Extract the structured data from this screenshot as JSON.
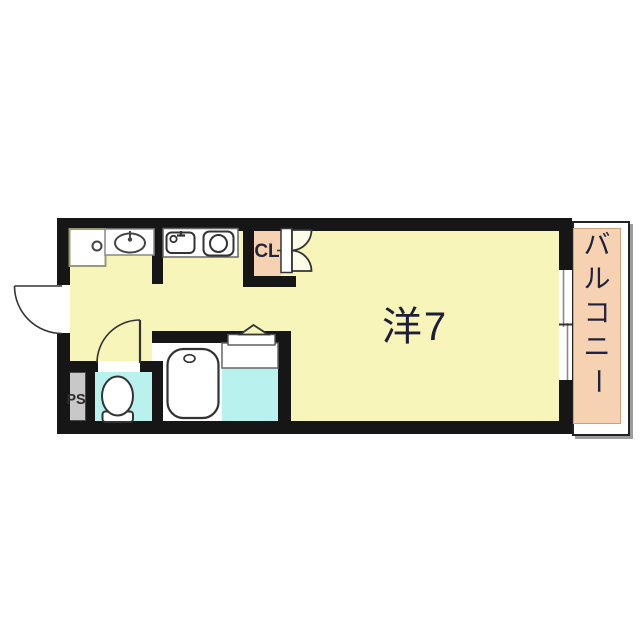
{
  "plan": {
    "labels": {
      "room": "洋7",
      "closet": "CL",
      "pipe_space": "PS",
      "balcony": "バルコニー"
    },
    "balcony_chars": [
      "バ",
      "ル",
      "コ",
      "ニ",
      "ー"
    ],
    "colors": {
      "floor_yellow": "#f8f5bb",
      "balcony_peach": "#f6d2b3",
      "wet_area_cyan": "#b9f1ee",
      "pipe_space_gray": "#c8c8c8",
      "wall_black": "#161616",
      "label_ink": "#20233b",
      "shadow_gray": "#9c9c9c"
    },
    "fixtures": [
      "washing-machine-pan-icon",
      "vanity-sink-icon",
      "kitchen-sink-icon",
      "stove-burner-icon",
      "closet-bifold-doors-icon",
      "washroom-door-icon",
      "entrance-door-arc-icon",
      "toilet-door-arc-icon",
      "bathtub-icon",
      "toilet-icon",
      "window-icon"
    ]
  }
}
